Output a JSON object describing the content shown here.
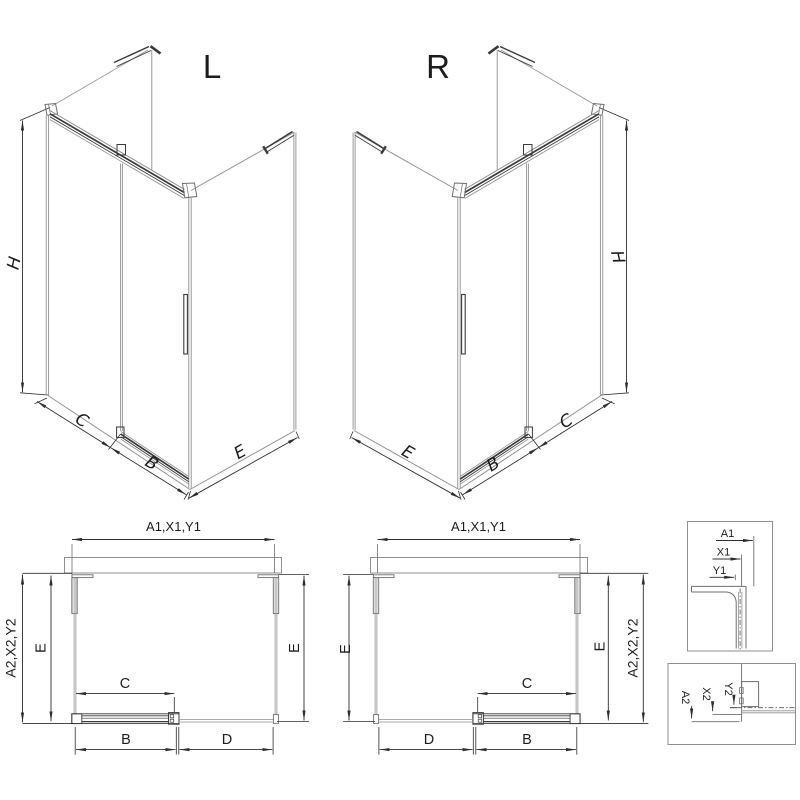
{
  "page": {
    "background": "#ffffff"
  },
  "colors": {
    "line_gray": "#8f8f8f",
    "line_dark": "#2e2e2e",
    "text": "#1c1c1c"
  },
  "iso_left": {
    "title": "L",
    "labels": {
      "height": "H",
      "fixed_panel": "C",
      "door": "B",
      "side_panel": "E"
    }
  },
  "iso_right": {
    "title": "R",
    "labels": {
      "height": "H",
      "fixed_panel": "C",
      "door": "B",
      "side_panel": "E"
    }
  },
  "plan_left": {
    "width_top": "A1,X1,Y1",
    "depth_outer": "A2,X2,Y2",
    "depth_left": "E",
    "depth_right": "E",
    "clear_width": "C",
    "door_width": "B",
    "fixed_width": "D"
  },
  "plan_right": {
    "width_top": "A1,X1,Y1",
    "depth_outer": "A2,X2,Y2",
    "depth_left": "E",
    "depth_right": "E",
    "clear_width": "C",
    "door_width": "B",
    "fixed_width": "D"
  },
  "detail_top": {
    "a1": "A1",
    "x1": "X1",
    "y1": "Y1"
  },
  "detail_bottom": {
    "a2": "A2",
    "x2": "X2",
    "y2": "Y2"
  }
}
